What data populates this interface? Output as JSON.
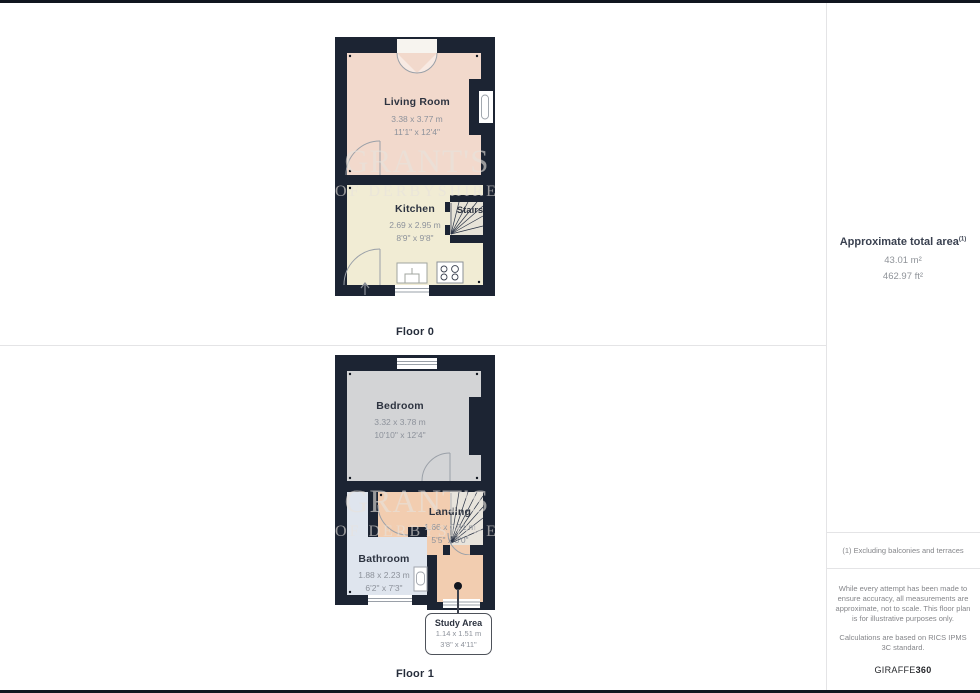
{
  "watermark": {
    "line1": "GRANT'S",
    "line2": "OF DERBYSHIRE"
  },
  "floors": [
    {
      "label": "Floor 0",
      "rooms": [
        {
          "name": "Living Room",
          "metric": "3.38 x 3.77 m",
          "imperial": "11'1\" x 12'4\""
        },
        {
          "name": "Kitchen",
          "metric": "2.69 x 2.95 m",
          "imperial": "8'9\" x 9'8\""
        },
        {
          "name": "Stairs",
          "metric": "",
          "imperial": ""
        }
      ]
    },
    {
      "label": "Floor 1",
      "rooms": [
        {
          "name": "Bedroom",
          "metric": "3.32 x 3.78 m",
          "imperial": "10'10\" x 12'4\""
        },
        {
          "name": "Landing",
          "metric": "1.66 x 0.91 m",
          "imperial": "5'5\" x 3'0\""
        },
        {
          "name": "Bathroom",
          "metric": "1.88 x 2.23 m",
          "imperial": "6'2\" x 7'3\""
        },
        {
          "name": "Study Area",
          "metric": "1.14 x 1.51 m",
          "imperial": "3'8\" x 4'11\""
        }
      ]
    }
  ],
  "sidebar": {
    "total_area_heading": "Approximate total area",
    "total_area_footnote_marker": "(1)",
    "total_area_m2": "43.01 m²",
    "total_area_ft2": "462.97 ft²",
    "footnote": "(1) Excluding balconies and terraces",
    "disclaimer_line1": "While every attempt has been made to ensure accuracy, all measurements are approximate, not to scale. This floor plan is for illustrative purposes only.",
    "disclaimer_line2": "Calculations are based on RICS IPMS 3C standard.",
    "brand_name": "GIRAFFE",
    "brand_suffix": "360"
  },
  "colors": {
    "wall": "#1c2433",
    "living_room_floor": "#f2d9cc",
    "kitchen_floor": "#f1ecd4",
    "bedroom_floor": "#d3d4d6",
    "landing_floor": "#f2cdb0",
    "bathroom_floor": "#dfe5ee",
    "study_floor": "#f2cdb0",
    "stairs_fill": "#e7e3d8",
    "room_text": "#2d3340",
    "dim_text": "#8d929b",
    "divider": "#e4e4e6"
  }
}
